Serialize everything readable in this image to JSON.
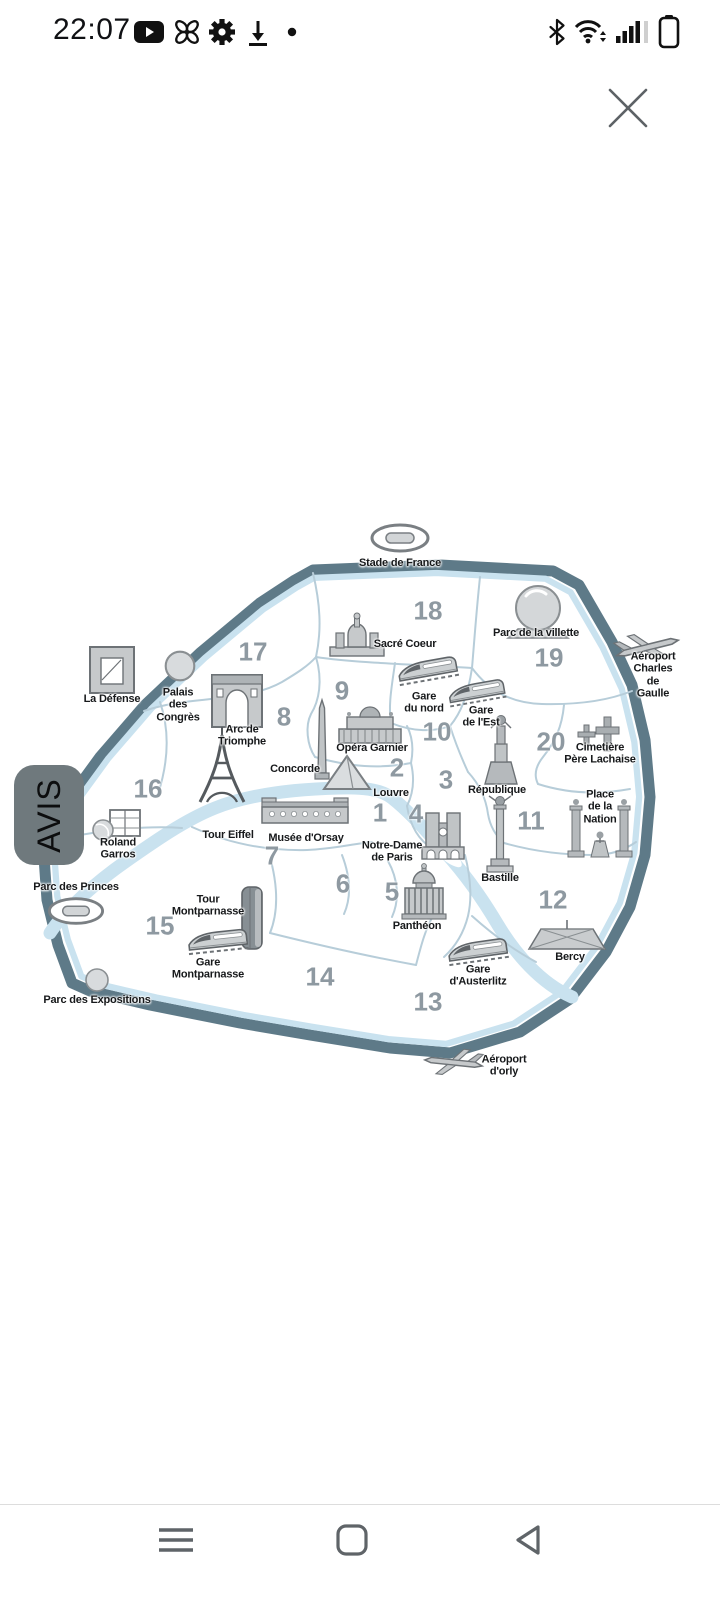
{
  "status_bar": {
    "time": "22:07",
    "left_icons": [
      "youtube-icon",
      "fan-icon",
      "gear-icon",
      "download-icon",
      "notification-dot"
    ],
    "right_icons": [
      "bluetooth-icon",
      "wifi-icon",
      "signal-icon",
      "sim2-no-signal-icon",
      "battery-icon"
    ]
  },
  "overlay": {
    "close_icon": "x-close"
  },
  "avis_tab": {
    "label": "AVIS"
  },
  "map": {
    "title": "Paris arrondissements map",
    "arrondissements": [
      {
        "number": "1"
      },
      {
        "number": "2"
      },
      {
        "number": "3"
      },
      {
        "number": "4"
      },
      {
        "number": "5"
      },
      {
        "number": "6"
      },
      {
        "number": "7"
      },
      {
        "number": "8"
      },
      {
        "number": "9"
      },
      {
        "number": "10"
      },
      {
        "number": "11"
      },
      {
        "number": "12"
      },
      {
        "number": "13"
      },
      {
        "number": "14"
      },
      {
        "number": "15"
      },
      {
        "number": "16"
      },
      {
        "number": "17"
      },
      {
        "number": "18"
      },
      {
        "number": "19"
      },
      {
        "number": "20"
      }
    ],
    "landmarks": [
      {
        "label": "Stade de France"
      },
      {
        "label": "Sacré Coeur"
      },
      {
        "label": "Parc de la villette"
      },
      {
        "label": "Aéroport\nCharles de Gaulle"
      },
      {
        "label": "La Défense"
      },
      {
        "label": "Palais\ndes\nCongrès"
      },
      {
        "label": "Arc de\nTriomphe"
      },
      {
        "label": "Gare\ndu nord"
      },
      {
        "label": "Gare\nde l'Est"
      },
      {
        "label": "Opéra Garnier"
      },
      {
        "label": "Cimetière\nPère Lachaise"
      },
      {
        "label": "Concorde"
      },
      {
        "label": "Louvre"
      },
      {
        "label": "République"
      },
      {
        "label": "Place\nde la\nNation"
      },
      {
        "label": "Tour Eiffel"
      },
      {
        "label": "Musée d'Orsay"
      },
      {
        "label": "Notre-Dame\nde Paris"
      },
      {
        "label": "Bastille"
      },
      {
        "label": "Roland\nGarros"
      },
      {
        "label": "Parc des Princes"
      },
      {
        "label": "Tour\nMontparnasse"
      },
      {
        "label": "Gare\nMontparnasse"
      },
      {
        "label": "Panthéon"
      },
      {
        "label": "Gare\nd'Austerlitz"
      },
      {
        "label": "Bercy"
      },
      {
        "label": "Parc des Expositions"
      },
      {
        "label": "Aéroport\nd'orly"
      }
    ],
    "colors": {
      "ring": "#5e7a88",
      "water": "#c9e2ef",
      "boundary": "#b7cdd9",
      "number": "#8e99a1",
      "label": "#17191b",
      "avis_bg": "#6f797d",
      "nav_icon": "#5f6468"
    }
  },
  "nav_bar": {
    "icons": [
      "menu-icon",
      "home-icon",
      "back-icon"
    ]
  }
}
